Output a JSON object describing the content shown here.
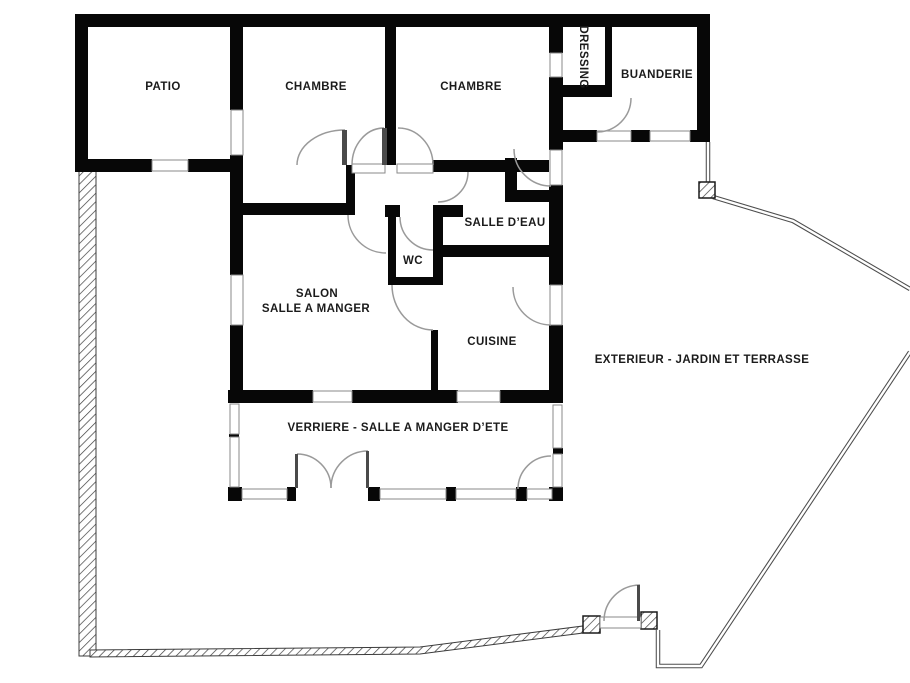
{
  "plan": {
    "type": "floor-plan",
    "language": "fr",
    "colors": {
      "walls": "#070707",
      "background": "#ffffff",
      "door_arcs": "#9a9a9a",
      "text": "#1b1b1b"
    },
    "rooms": {
      "patio": {
        "label": "PATIO"
      },
      "chambre_1": {
        "label": "CHAMBRE"
      },
      "chambre_2": {
        "label": "CHAMBRE"
      },
      "dressing": {
        "label": "DRESSING"
      },
      "buanderie": {
        "label": "BUANDERIE"
      },
      "salle_deau": {
        "label": "SALLE D’EAU"
      },
      "wc": {
        "label": "WC"
      },
      "salon_line1": {
        "label": "SALON"
      },
      "salon_line2": {
        "label": "SALLE A MANGER"
      },
      "cuisine": {
        "label": "CUISINE"
      },
      "verriere": {
        "label": "VERRIERE - SALLE A MANGER D’ETE"
      },
      "exterieur": {
        "label": "EXTERIEUR - JARDIN ET TERRASSE"
      }
    }
  }
}
